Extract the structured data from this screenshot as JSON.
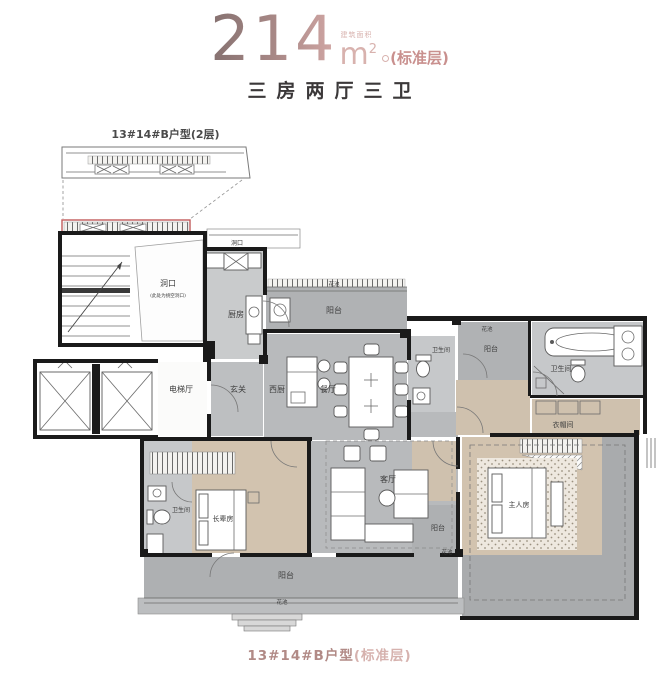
{
  "header": {
    "area": "214",
    "area_label": "建筑面积",
    "unit": "m",
    "unit_sup": "2",
    "floor_note": "(标准层)",
    "subtitle": "三房两厅三卫"
  },
  "inset": {
    "label": "13#14#B户型(2层)"
  },
  "caption": {
    "name": "13#14#B户型",
    "note": "(标准层)"
  },
  "colors": {
    "accent_pink": "#d8b2ae",
    "title_gradient_start": "#857170",
    "title_gradient_end": "#d3a8a6",
    "caption_pink": "#b18a86",
    "highlight_red": "#c25c5c",
    "wall_black": "#1a1a1a",
    "marble_gray": "#b8babc",
    "wood_tan": "#d2c3af"
  },
  "labels": {
    "void": "洞口",
    "void_note": "(此处为挑空洞口)",
    "void_small": "洞口",
    "kitchen": "厨房",
    "balcony_north": "阳台",
    "flower_north": "花池",
    "elevator_hall": "电梯厅",
    "foyer": "玄关",
    "west_kitchen": "西厨",
    "dining": "餐厅",
    "bath_guest": "卫生间",
    "balcony_ne": "阳台",
    "flower_ne": "花池",
    "bath_master": "卫生间",
    "closet": "衣帽间",
    "living": "客厅",
    "bath_elder": "卫生间",
    "elder_room": "长辈房",
    "master_room": "主人房",
    "balcony_south": "阳台",
    "balcony_se": "阳台",
    "flower_south": "花池",
    "flower_se": "花池"
  }
}
